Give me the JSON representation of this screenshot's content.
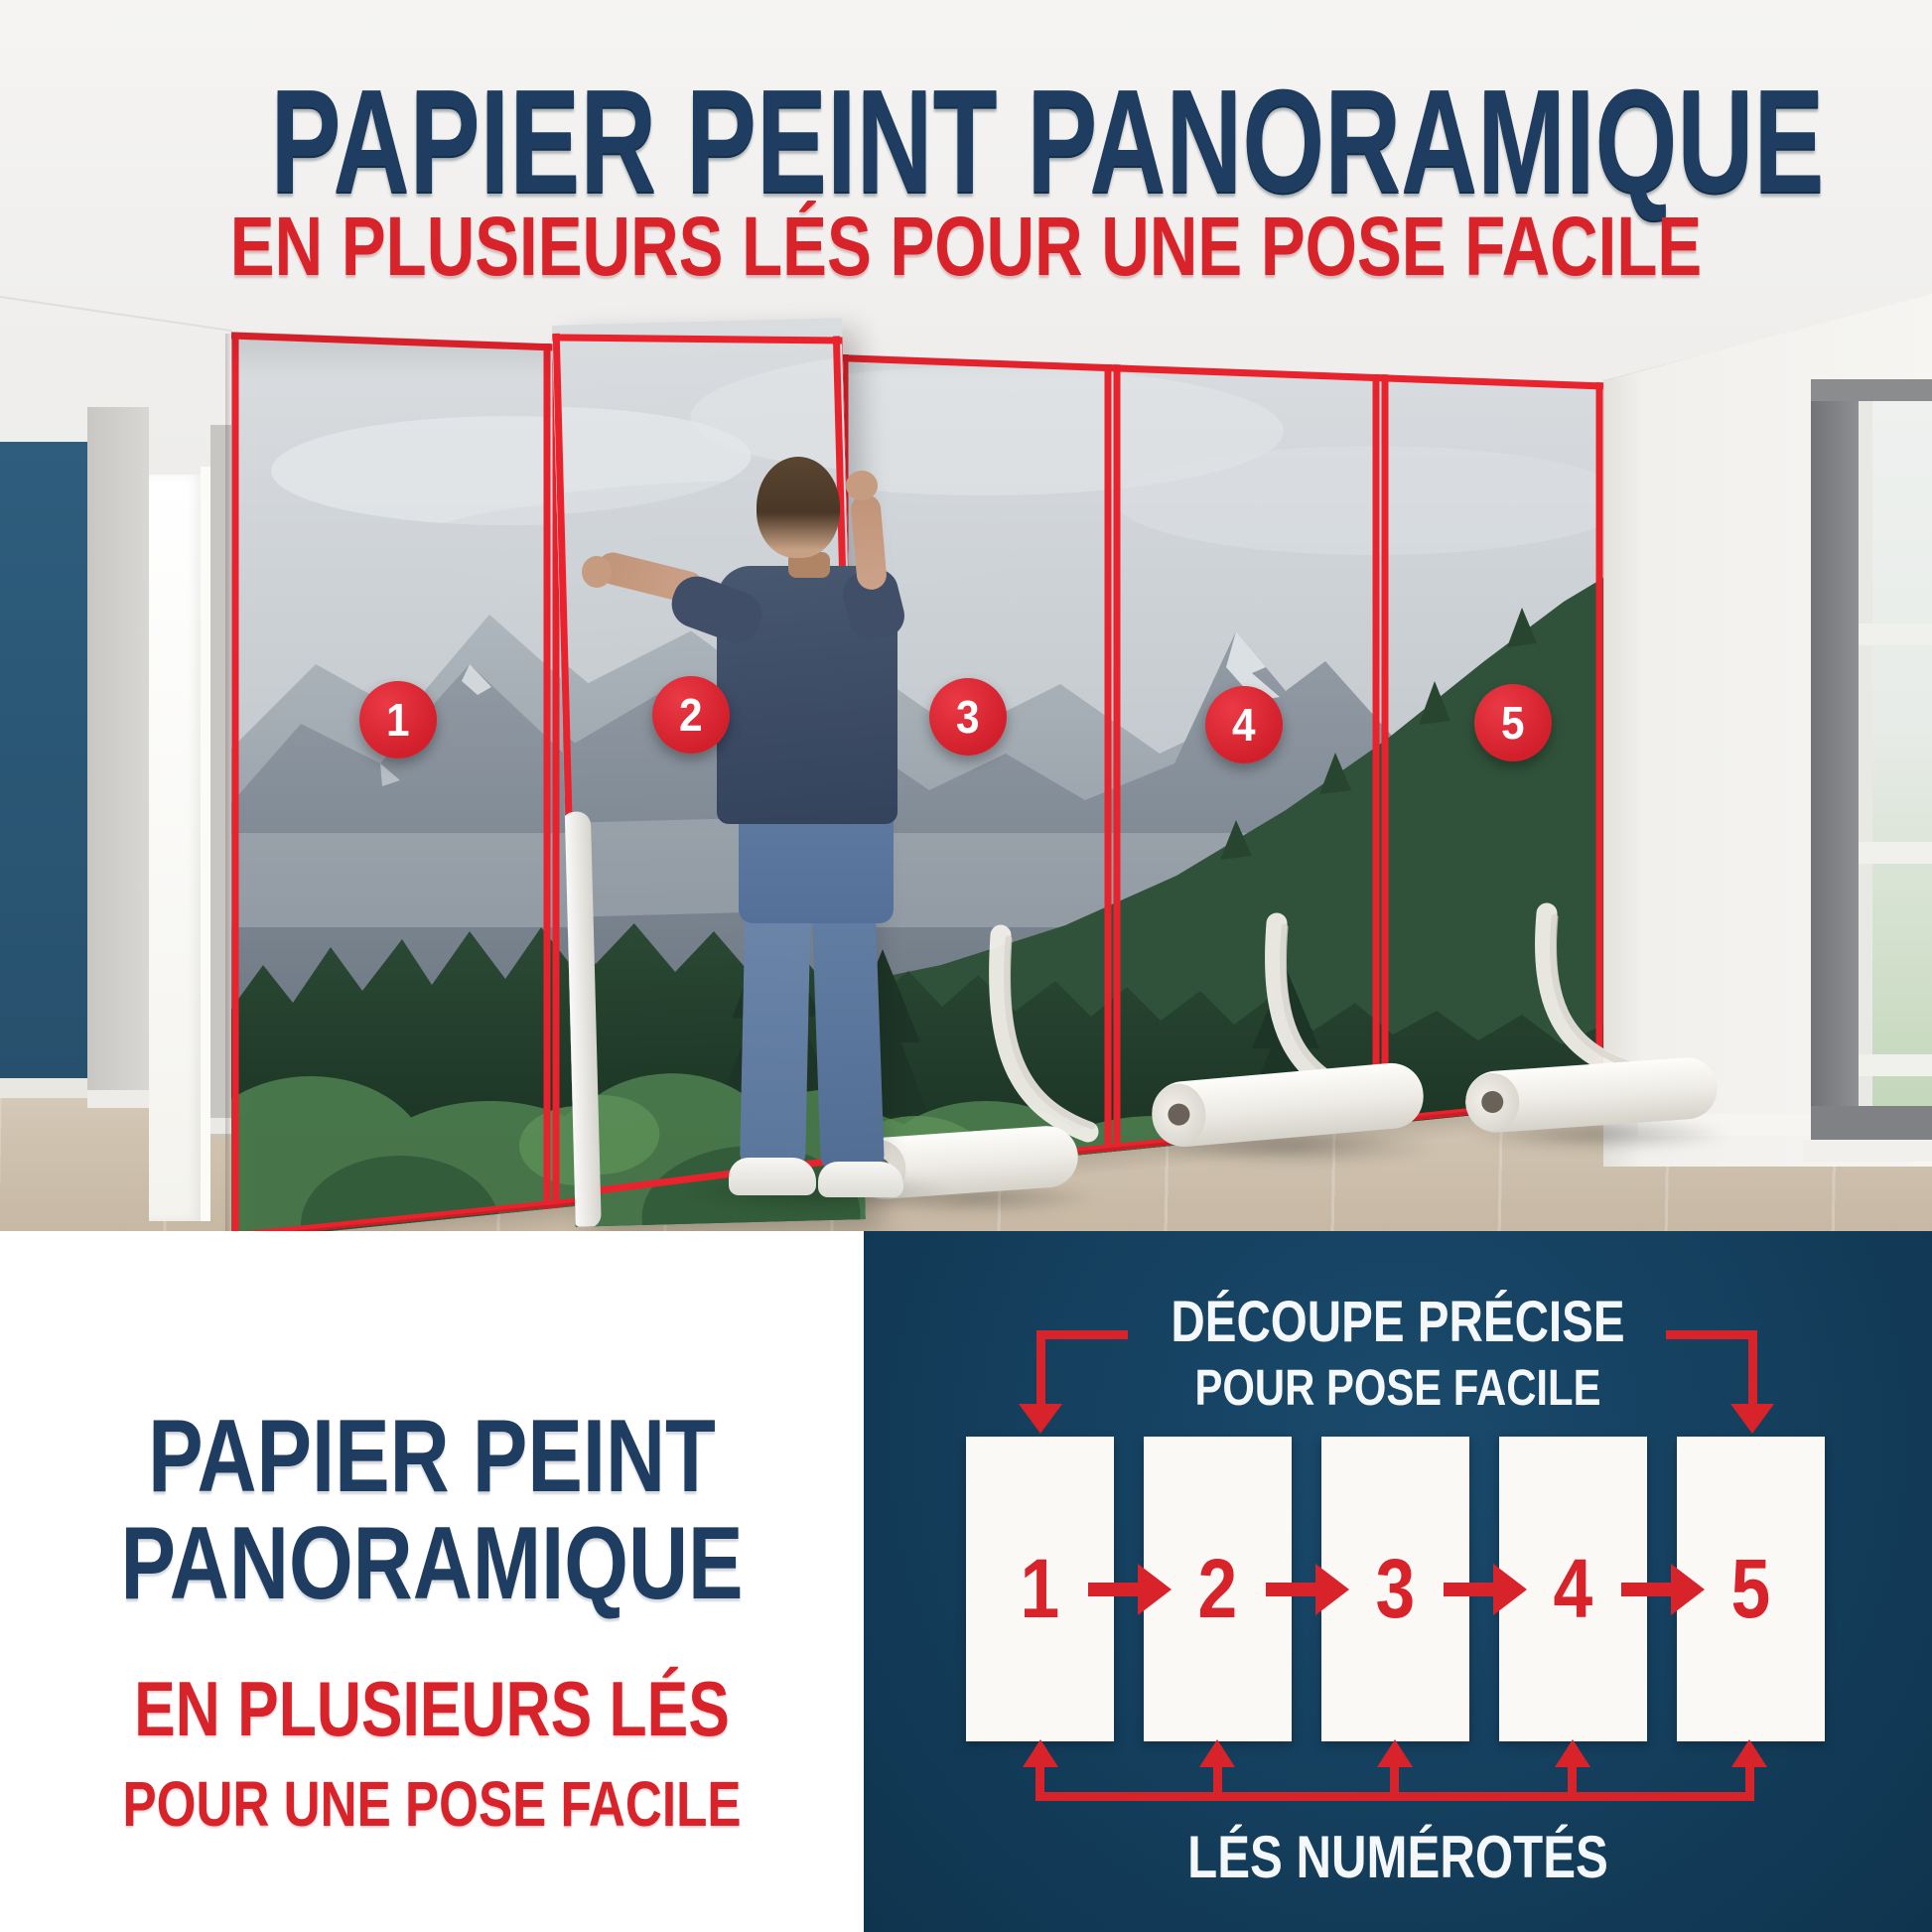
{
  "header": {
    "title": "PAPIER PEINT PANORAMIQUE",
    "subtitle": "EN PLUSIEURS LÉS POUR UNE POSE FACILE"
  },
  "photo": {
    "strip_labels": [
      "1",
      "2",
      "3",
      "4",
      "5"
    ]
  },
  "bottom_left": {
    "title_line1": "PAPIER PEINT",
    "title_line2": "PANORAMIQUE",
    "subtitle_line1": "EN PLUSIEURS LÉS",
    "subtitle_line2": "POUR UNE POSE FACILE"
  },
  "diagram": {
    "heading_line1": "DÉCOUPE PRÉCISE",
    "heading_line2": "POUR POSE FACILE",
    "strip_labels": [
      "1",
      "2",
      "3",
      "4",
      "5"
    ],
    "caption": "LÉS NUMÉROTÉS"
  },
  "colors": {
    "navy_panel": "#143e5c",
    "title_navy": "#1e3d60",
    "accent_red": "#d8232a",
    "accent_wall_blue": "#2b5876"
  }
}
